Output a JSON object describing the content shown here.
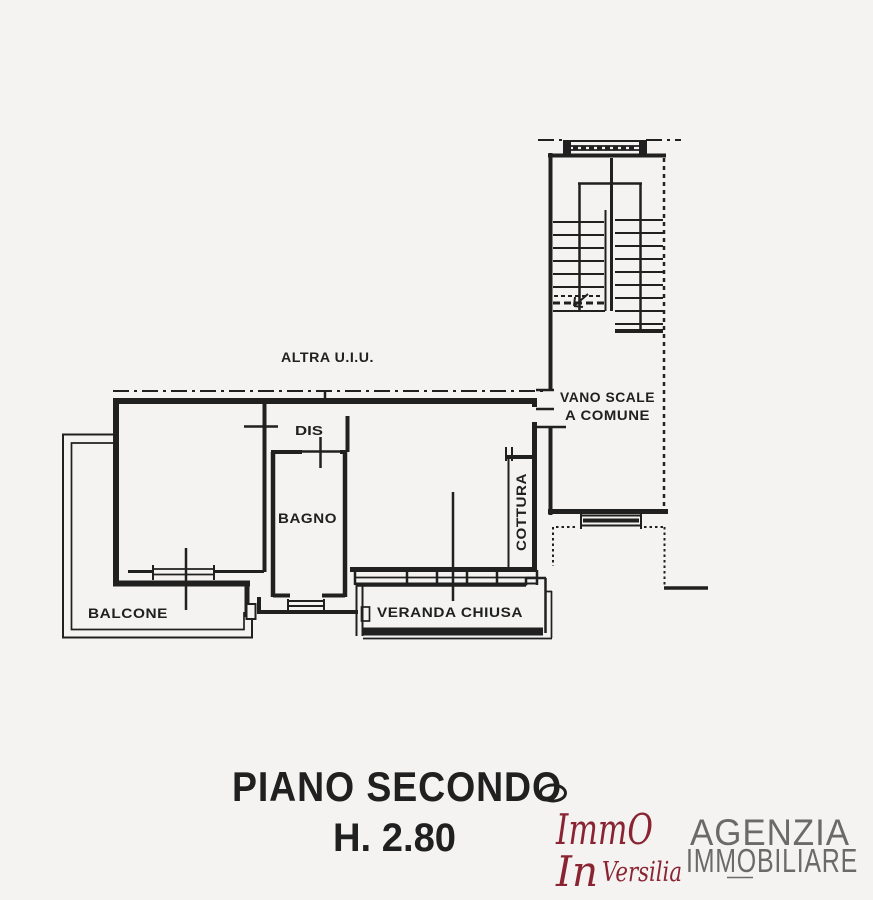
{
  "plan": {
    "labels": {
      "altra_uiu": "ALTRA U.I.U.",
      "vano_scale_line1": "VANO SCALE",
      "vano_scale_line2": "A COMUNE",
      "dis": "DIS",
      "bagno": "BAGNO",
      "cottura": "COTTURA",
      "balcone": "BALCONE",
      "veranda_chiusa": "VERANDA CHIUSA"
    }
  },
  "caption": {
    "floor": "PIANO SECONDO",
    "height": "H. 2.80"
  },
  "logo": {
    "brand_line1": "ImmO",
    "brand_line2": "In",
    "brand_line3": "Versilia",
    "agency_line1": "AGENZIA",
    "agency_line2": "IMMOBILIARE"
  },
  "colors": {
    "ink": "#202020",
    "brand_red": "#8a2432",
    "agency_gray": "#6a6a6a",
    "paper": "#f4f3f2"
  }
}
